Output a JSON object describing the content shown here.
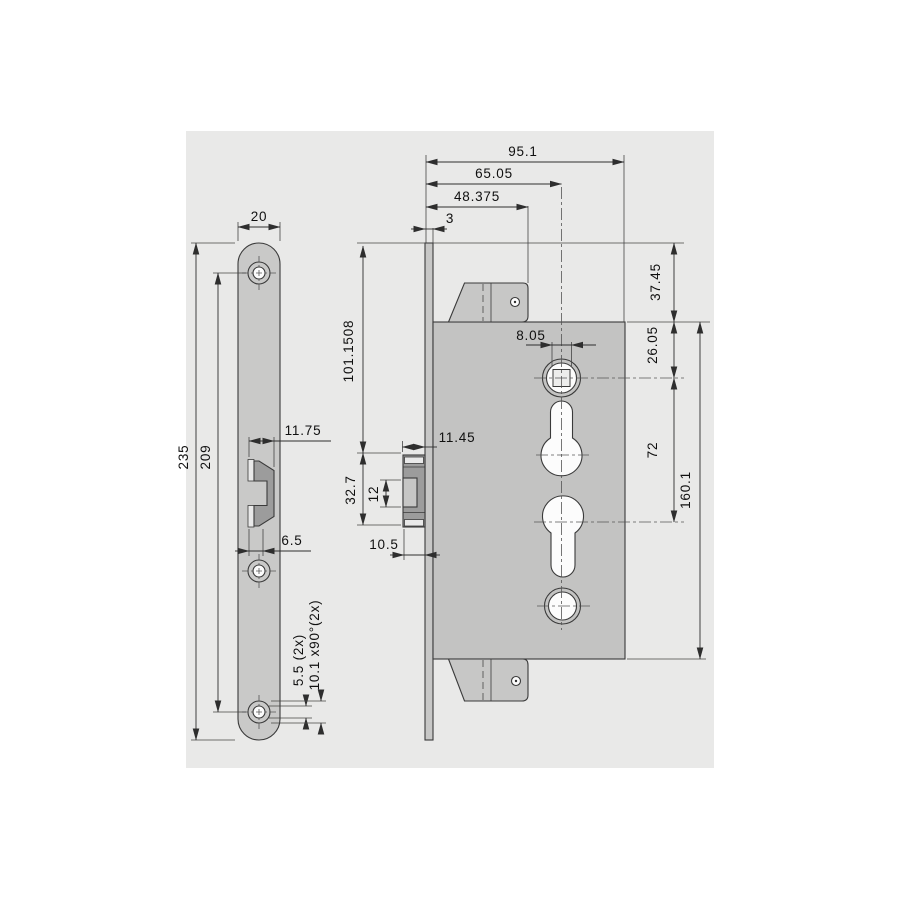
{
  "dims": {
    "plate_width": "20",
    "plate_height": "235",
    "plate_hole_spacing": "209",
    "keeper_width": "11.75",
    "keeper_lip": "6.5",
    "plate_hole_dia": "5.5 (2x)",
    "plate_countersink": "10.1 x90°(2x)",
    "case_depth": "95.1",
    "backset": "65.05",
    "tab_depth": "48.375",
    "faceplate_thickness": "3",
    "top_to_bolt": "101.1508",
    "top_to_case": "37.45",
    "case_to_spindle": "26.05",
    "spindle_square": "8.05",
    "spindle_to_cylinder": "72",
    "case_height": "160.1",
    "bolt_throw": "11.45",
    "bolt_height": "32.7",
    "bolt_head_height": "12",
    "bolt_head_throw": "10.5"
  },
  "colors": {
    "canvas": "#e9e9e8",
    "plate_fill": "#c9c9c8",
    "body_fill": "#c3c3c2",
    "bolt_fill": "#9c9c9c",
    "line": "#3a3a3a"
  }
}
